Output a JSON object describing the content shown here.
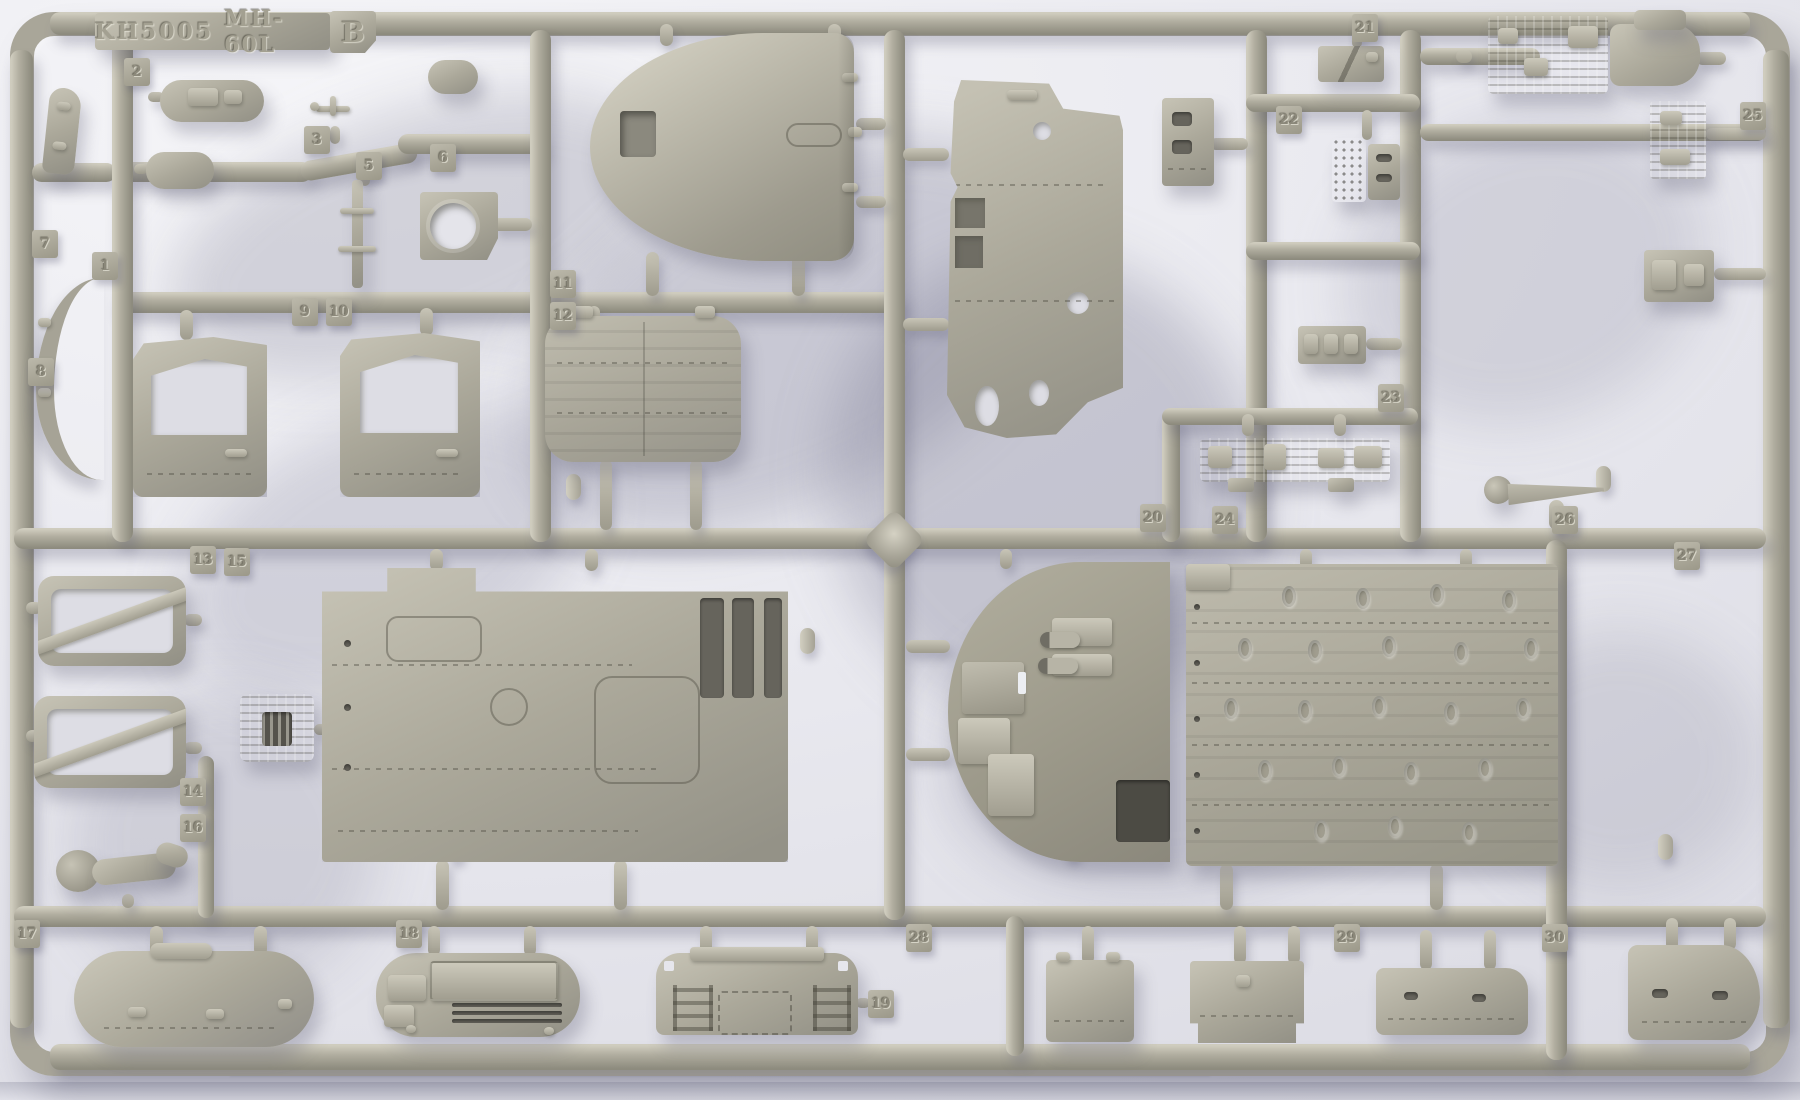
{
  "title_plate": {
    "kit_number": "KH5005",
    "model": "MH-60L",
    "sprue_letter": "B"
  },
  "part_tabs": [
    {
      "label": "2"
    },
    {
      "label": "3"
    },
    {
      "label": "5"
    },
    {
      "label": "6"
    },
    {
      "label": "1"
    },
    {
      "label": "7"
    },
    {
      "label": "8"
    },
    {
      "label": "9"
    },
    {
      "label": "10"
    },
    {
      "label": "11"
    },
    {
      "label": "12"
    },
    {
      "label": "13"
    },
    {
      "label": "15"
    },
    {
      "label": "14"
    },
    {
      "label": "16"
    },
    {
      "label": "17"
    },
    {
      "label": "18"
    },
    {
      "label": "19"
    },
    {
      "label": "20"
    },
    {
      "label": "24"
    },
    {
      "label": "21"
    },
    {
      "label": "22"
    },
    {
      "label": "23"
    },
    {
      "label": "25"
    },
    {
      "label": "26"
    },
    {
      "label": "27"
    },
    {
      "label": "28"
    },
    {
      "label": "29"
    },
    {
      "label": "30"
    }
  ],
  "colors": {
    "plastic": "#aba89a",
    "plastic_highlight": "#cfccbe",
    "plastic_shadow": "#8d8b7e",
    "backdrop": "#e9e9ef",
    "cast_shadow": "#8f8fa8"
  }
}
